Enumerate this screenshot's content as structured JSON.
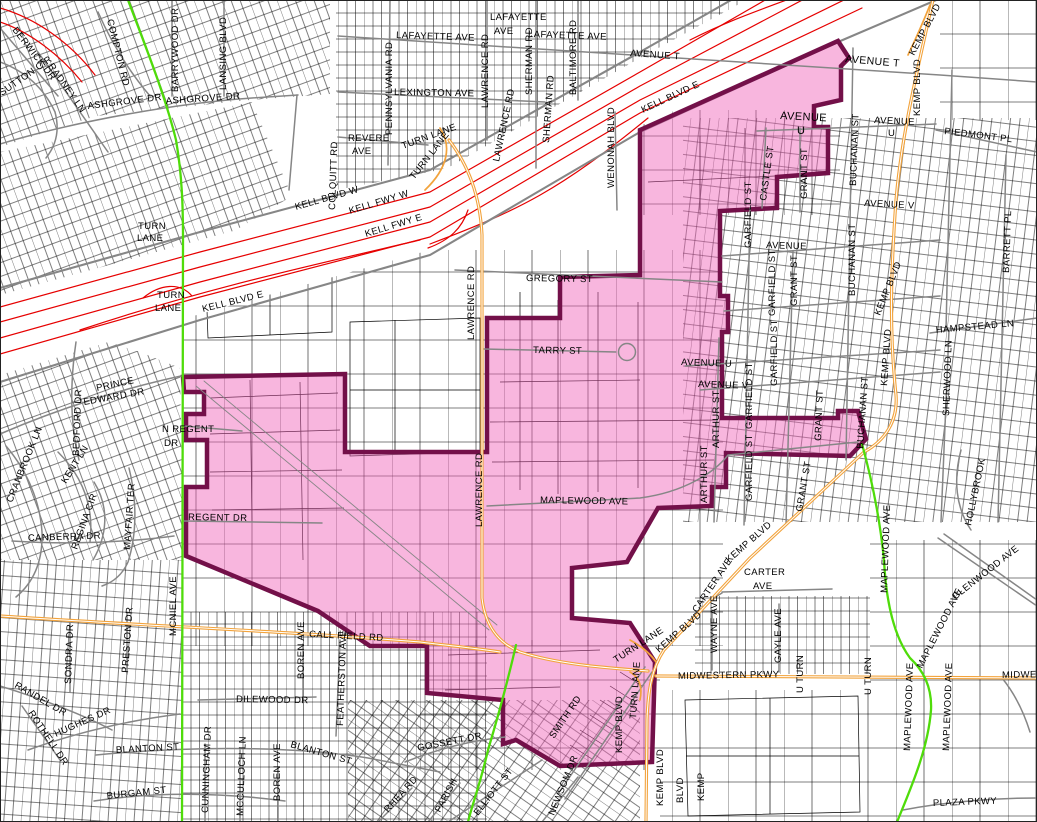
{
  "colors": {
    "freeway_red": "#e60000",
    "major_road_orange": "#f2a33c",
    "collector_green": "#4fdc0a",
    "street_gray": "#868686",
    "parcel_line": "#000000",
    "district_fill": "#f8c9e6",
    "district_border": "#731049"
  },
  "district": {
    "description": "highlighted district boundary polygon"
  },
  "map_labels": [
    {
      "t": "SUTTON CIR",
      "x": 2,
      "y": 96,
      "r": -35
    },
    {
      "t": "BERWICK DR",
      "x": 12,
      "y": 30,
      "r": 52
    },
    {
      "t": "RADNEY LN",
      "x": 48,
      "y": 66,
      "r": 55
    },
    {
      "t": "COMPTON RD",
      "x": 107,
      "y": 20,
      "r": 76
    },
    {
      "t": "ASHGROVE DR",
      "x": 88,
      "y": 109,
      "r": -7
    },
    {
      "t": "ASHGROVE DR",
      "x": 166,
      "y": 104,
      "r": -4
    },
    {
      "t": "BARRYWOOD DR",
      "x": 178,
      "y": 92,
      "r": -90
    },
    {
      "t": "LANSING BLVD",
      "x": 226,
      "y": 90,
      "r": -90
    },
    {
      "t": "COLQUITT RD",
      "x": 335,
      "y": 210,
      "r": -88
    },
    {
      "t": "TURN",
      "x": 138,
      "y": 229,
      "r": 0
    },
    {
      "t": "LANE",
      "x": 137,
      "y": 241,
      "r": 0
    },
    {
      "t": "TURN",
      "x": 157,
      "y": 298,
      "r": 0
    },
    {
      "t": "LANE",
      "x": 155,
      "y": 311,
      "r": 0
    },
    {
      "t": "KELL BLVD E",
      "x": 203,
      "y": 312,
      "r": -14
    },
    {
      "t": "KELL BLVD W",
      "x": 296,
      "y": 210,
      "r": -16
    },
    {
      "t": "KELL FWY W",
      "x": 350,
      "y": 214,
      "r": -17
    },
    {
      "t": "KELL FWY E",
      "x": 366,
      "y": 237,
      "r": -17
    },
    {
      "t": "TURN LANE",
      "x": 403,
      "y": 149,
      "r": -20
    },
    {
      "t": "TURN LANE",
      "x": 414,
      "y": 180,
      "r": -52
    },
    {
      "t": "KELL BLVD E",
      "x": 643,
      "y": 113,
      "r": -25
    },
    {
      "t": "PENNSYLVANIA RD",
      "x": 392,
      "y": 135,
      "r": -90
    },
    {
      "t": "LAFAYETTE AVE",
      "x": 396,
      "y": 38,
      "r": 2
    },
    {
      "t": "LAFAYETTE",
      "x": 490,
      "y": 20,
      "r": 0
    },
    {
      "t": "AVE",
      "x": 494,
      "y": 34,
      "r": 0
    },
    {
      "t": "LAFAYETTE AVE",
      "x": 528,
      "y": 37,
      "r": 2
    },
    {
      "t": "LEXINGTON AVE",
      "x": 394,
      "y": 95,
      "r": 1
    },
    {
      "t": "LAWRENCE RD",
      "x": 488,
      "y": 108,
      "r": -90
    },
    {
      "t": "LAWRENCE RD",
      "x": 499,
      "y": 162,
      "r": -78
    },
    {
      "t": "SHERMAN RD",
      "x": 532,
      "y": 95,
      "r": -90
    },
    {
      "t": "SHERMAN RD",
      "x": 549,
      "y": 143,
      "r": -86
    },
    {
      "t": "BALTIMORE RD",
      "x": 576,
      "y": 95,
      "r": -90
    },
    {
      "t": "REVERE",
      "x": 348,
      "y": 141,
      "r": 0
    },
    {
      "t": "AVE",
      "x": 352,
      "y": 154,
      "r": 0
    },
    {
      "t": "WENONAH BLVD",
      "x": 614,
      "y": 188,
      "r": -90
    },
    {
      "t": "AVENUE T",
      "x": 630,
      "y": 56,
      "r": 4
    },
    {
      "t": "AVENUE T",
      "x": 845,
      "y": 62,
      "r": 5,
      "s": 10.5
    },
    {
      "t": "KEMP BLVD",
      "x": 914,
      "y": 56,
      "r": -62
    },
    {
      "t": "KEMP BLVD",
      "x": 920,
      "y": 116,
      "r": -90
    },
    {
      "t": "AVENUE",
      "x": 780,
      "y": 119,
      "r": 3,
      "s": 11
    },
    {
      "t": "U",
      "x": 797,
      "y": 134,
      "r": 0,
      "s": 11
    },
    {
      "t": "AVENUE",
      "x": 874,
      "y": 123,
      "r": 3
    },
    {
      "t": "U",
      "x": 888,
      "y": 136,
      "r": 0
    },
    {
      "t": "PIEDMONT PL",
      "x": 944,
      "y": 134,
      "r": 7
    },
    {
      "t": "GRANT ST",
      "x": 807,
      "y": 199,
      "r": -90
    },
    {
      "t": "BUCHANAN ST",
      "x": 856,
      "y": 186,
      "r": -88
    },
    {
      "t": "CASTLE ST",
      "x": 766,
      "y": 201,
      "r": -82
    },
    {
      "t": "GARFIELD ST",
      "x": 751,
      "y": 248,
      "r": -90
    },
    {
      "t": "AVENUE V",
      "x": 864,
      "y": 206,
      "r": 3
    },
    {
      "t": "AVENUE",
      "x": 766,
      "y": 248,
      "r": 2
    },
    {
      "t": "GARFIELD ST",
      "x": 775,
      "y": 316,
      "r": -90
    },
    {
      "t": "GARFIELD ST",
      "x": 777,
      "y": 386,
      "r": -90
    },
    {
      "t": "GARFIELD ST",
      "x": 752,
      "y": 429,
      "r": -90
    },
    {
      "t": "GARFIELD ST",
      "x": 752,
      "y": 501,
      "r": -90
    },
    {
      "t": "GRANT ST",
      "x": 797,
      "y": 306,
      "r": -90
    },
    {
      "t": "GRANT ST",
      "x": 821,
      "y": 441,
      "r": -88
    },
    {
      "t": "GRANT ST",
      "x": 802,
      "y": 512,
      "r": -80
    },
    {
      "t": "BUCHANAN ST",
      "x": 855,
      "y": 296,
      "r": -90
    },
    {
      "t": "BUCHANAN ST",
      "x": 863,
      "y": 449,
      "r": -86
    },
    {
      "t": "KEMP BLVD",
      "x": 880,
      "y": 316,
      "r": -68
    },
    {
      "t": "KEMP BLVD",
      "x": 887,
      "y": 386,
      "r": -86
    },
    {
      "t": "HAMPSTEAD LN",
      "x": 936,
      "y": 333,
      "r": -5
    },
    {
      "t": "ARTHUR ST",
      "x": 719,
      "y": 448,
      "r": -90
    },
    {
      "t": "ARTHUR ST",
      "x": 707,
      "y": 503,
      "r": -90
    },
    {
      "t": "AVENUE U",
      "x": 681,
      "y": 365,
      "r": 2
    },
    {
      "t": "AVENUE V",
      "x": 698,
      "y": 387,
      "r": 2
    },
    {
      "t": "SHERWOOD LN",
      "x": 949,
      "y": 416,
      "r": -88
    },
    {
      "t": "BARRETT PL",
      "x": 1009,
      "y": 273,
      "r": -88
    },
    {
      "t": "MAPLEWOOD AVE",
      "x": 887,
      "y": 593,
      "r": -88
    },
    {
      "t": "GLENWOOD AVE",
      "x": 955,
      "y": 600,
      "r": -38
    },
    {
      "t": "HOLLYBROOK",
      "x": 971,
      "y": 526,
      "r": -78
    },
    {
      "t": "GREGORY ST",
      "x": 526,
      "y": 281,
      "r": 1
    },
    {
      "t": "TARRY ST",
      "x": 533,
      "y": 353,
      "r": 1
    },
    {
      "t": "LAWRENCE RD",
      "x": 474,
      "y": 340,
      "r": -90
    },
    {
      "t": "LAWRENCE RD",
      "x": 482,
      "y": 527,
      "r": -90
    },
    {
      "t": "MAPLEWOOD AVE",
      "x": 540,
      "y": 503,
      "r": 1
    },
    {
      "t": "N REGENT",
      "x": 162,
      "y": 432,
      "r": 0
    },
    {
      "t": "DR",
      "x": 164,
      "y": 446,
      "r": 0
    },
    {
      "t": "REGENT DR",
      "x": 188,
      "y": 520,
      "r": 1
    },
    {
      "t": "BEDFORD DR",
      "x": 79,
      "y": 456,
      "r": -88
    },
    {
      "t": "PRINCE",
      "x": 97,
      "y": 391,
      "r": -12
    },
    {
      "t": "EDWARD DR",
      "x": 84,
      "y": 405,
      "r": -10
    },
    {
      "t": "CRANBROOK LN",
      "x": 12,
      "y": 503,
      "r": -68
    },
    {
      "t": "KENT LN",
      "x": 66,
      "y": 484,
      "r": -58
    },
    {
      "t": "REGINA CIR",
      "x": 77,
      "y": 550,
      "r": -70
    },
    {
      "t": "MAYFAIR TER",
      "x": 130,
      "y": 550,
      "r": -86
    },
    {
      "t": "CANBERRA DR",
      "x": 28,
      "y": 541,
      "r": -2
    },
    {
      "t": "MCNIEL AVE",
      "x": 176,
      "y": 636,
      "r": -90
    },
    {
      "t": "SONDRA DR",
      "x": 71,
      "y": 684,
      "r": -88
    },
    {
      "t": "PRESTON DR",
      "x": 128,
      "y": 673,
      "r": -86
    },
    {
      "t": "RANDEL DR",
      "x": 14,
      "y": 687,
      "r": 30
    },
    {
      "t": "ROTHELL DR",
      "x": 28,
      "y": 713,
      "r": 56
    },
    {
      "t": "HUGHES DR",
      "x": 56,
      "y": 737,
      "r": -24
    },
    {
      "t": "BLANTON ST",
      "x": 116,
      "y": 753,
      "r": -3
    },
    {
      "t": "BLANTON ST",
      "x": 290,
      "y": 747,
      "r": 16
    },
    {
      "t": "BURGAM ST",
      "x": 107,
      "y": 799,
      "r": -6
    },
    {
      "t": "DILEWOOD DR",
      "x": 236,
      "y": 702,
      "r": 1
    },
    {
      "t": "BOREN AVE",
      "x": 304,
      "y": 679,
      "r": -90
    },
    {
      "t": "BOREN AVE",
      "x": 280,
      "y": 801,
      "r": -90
    },
    {
      "t": "CUNNINGHAM DR",
      "x": 208,
      "y": 813,
      "r": -88
    },
    {
      "t": "MCCULLOCH LN",
      "x": 243,
      "y": 816,
      "r": -88
    },
    {
      "t": "FEATHERSTON AVE",
      "x": 343,
      "y": 726,
      "r": -88
    },
    {
      "t": "CALL FIELD RD",
      "x": 309,
      "y": 637,
      "r": 3
    },
    {
      "t": "GOSSETT DR",
      "x": 418,
      "y": 751,
      "r": -11
    },
    {
      "t": "RHEA RD",
      "x": 388,
      "y": 813,
      "r": -48
    },
    {
      "t": "PARISH",
      "x": 440,
      "y": 813,
      "r": -62
    },
    {
      "t": "ELLIOTT ST",
      "x": 478,
      "y": 816,
      "r": -52
    },
    {
      "t": "NEWSOM DR",
      "x": 554,
      "y": 816,
      "r": -68
    },
    {
      "t": "SMITH RD",
      "x": 554,
      "y": 739,
      "r": -56
    },
    {
      "t": "TURN LANE",
      "x": 616,
      "y": 663,
      "r": -33
    },
    {
      "t": "TURN LANE",
      "x": 636,
      "y": 719,
      "r": -86
    },
    {
      "t": "KEMP BLVD",
      "x": 659,
      "y": 653,
      "r": -41
    },
    {
      "t": "KEMP BLVD",
      "x": 729,
      "y": 563,
      "r": -41
    },
    {
      "t": "CARTER",
      "x": 744,
      "y": 575,
      "r": 0
    },
    {
      "t": "AVE",
      "x": 753,
      "y": 589,
      "r": 0
    },
    {
      "t": "CARTER AVE",
      "x": 697,
      "y": 613,
      "r": -56
    },
    {
      "t": "WAYNE AVE",
      "x": 717,
      "y": 653,
      "r": -90
    },
    {
      "t": "GAYLE AVE",
      "x": 781,
      "y": 663,
      "r": -90
    },
    {
      "t": "MIDWESTERN PKWY",
      "x": 678,
      "y": 679,
      "r": -1
    },
    {
      "t": "MIDWESTERN PKWY",
      "x": 1002,
      "y": 678,
      "r": -1
    },
    {
      "t": "U TURN",
      "x": 803,
      "y": 693,
      "r": -90
    },
    {
      "t": "U TURN",
      "x": 871,
      "y": 695,
      "r": -90
    },
    {
      "t": "KEMP BLVD",
      "x": 622,
      "y": 753,
      "r": -90
    },
    {
      "t": "KEMP BLVD",
      "x": 663,
      "y": 806,
      "r": -90
    },
    {
      "t": "BLVD",
      "x": 683,
      "y": 803,
      "r": -90
    },
    {
      "t": "KEMP",
      "x": 704,
      "y": 801,
      "r": -90
    },
    {
      "t": "MAPLEWOOD AVE",
      "x": 922,
      "y": 669,
      "r": -63
    },
    {
      "t": "MAPLEWOOD AVE",
      "x": 910,
      "y": 751,
      "r": -88
    },
    {
      "t": "MAPLEWOOD AVE",
      "x": 949,
      "y": 751,
      "r": -88
    },
    {
      "t": "PLAZA PKWY",
      "x": 933,
      "y": 806,
      "r": -2
    }
  ]
}
